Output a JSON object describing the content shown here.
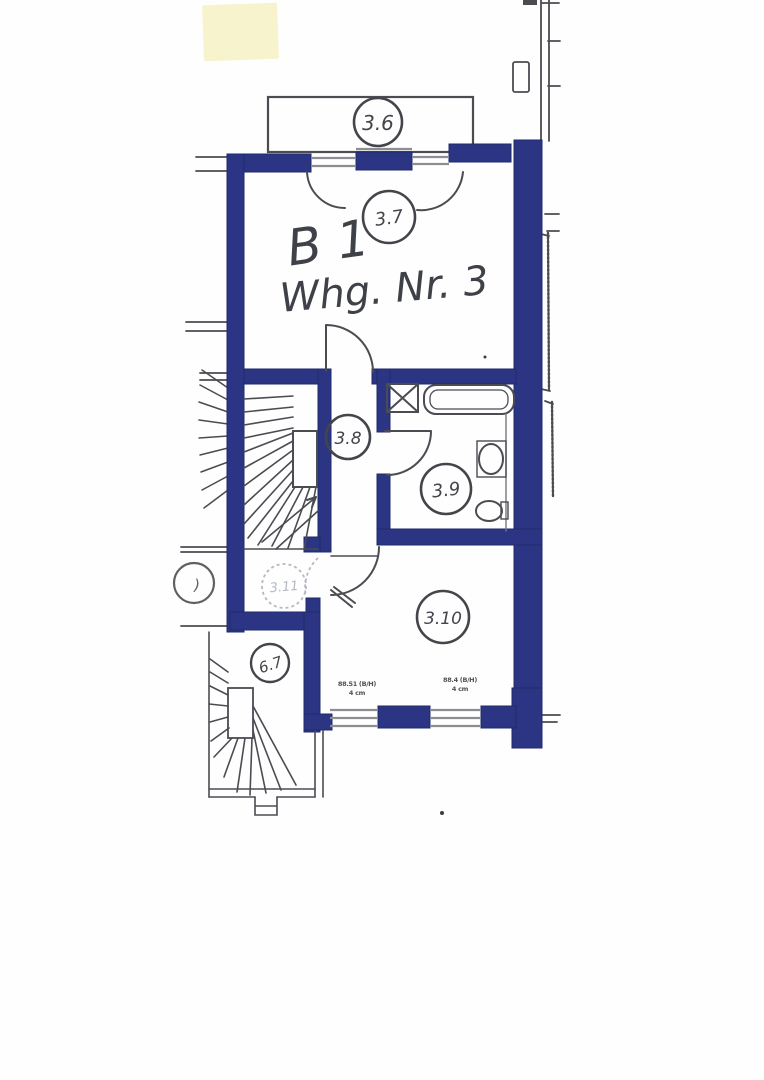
{
  "plan": {
    "handwriting": {
      "line1": "B 1",
      "line2": "Whg. Nr. 3"
    },
    "rooms": {
      "balcony": "3.6",
      "room_3_7": "3.7",
      "hall": "3.8",
      "bath": "3.9",
      "room_3_10": "3.10",
      "room_3_11": "3.11",
      "stairwell": "6.7",
      "partial": ")"
    },
    "window_labels": {
      "left": {
        "l1": "88.51 (B/H)",
        "l2": "4 cm"
      },
      "right": {
        "l1": "88.4 (B/H)",
        "l2": "4 cm"
      }
    },
    "colors": {
      "wall": "#2b3583",
      "line": "#4b4b52",
      "ink": "#43454a",
      "faint": "#b4b8c2",
      "note_bg": "#f6f3cd",
      "window": "#8d8d94"
    }
  }
}
